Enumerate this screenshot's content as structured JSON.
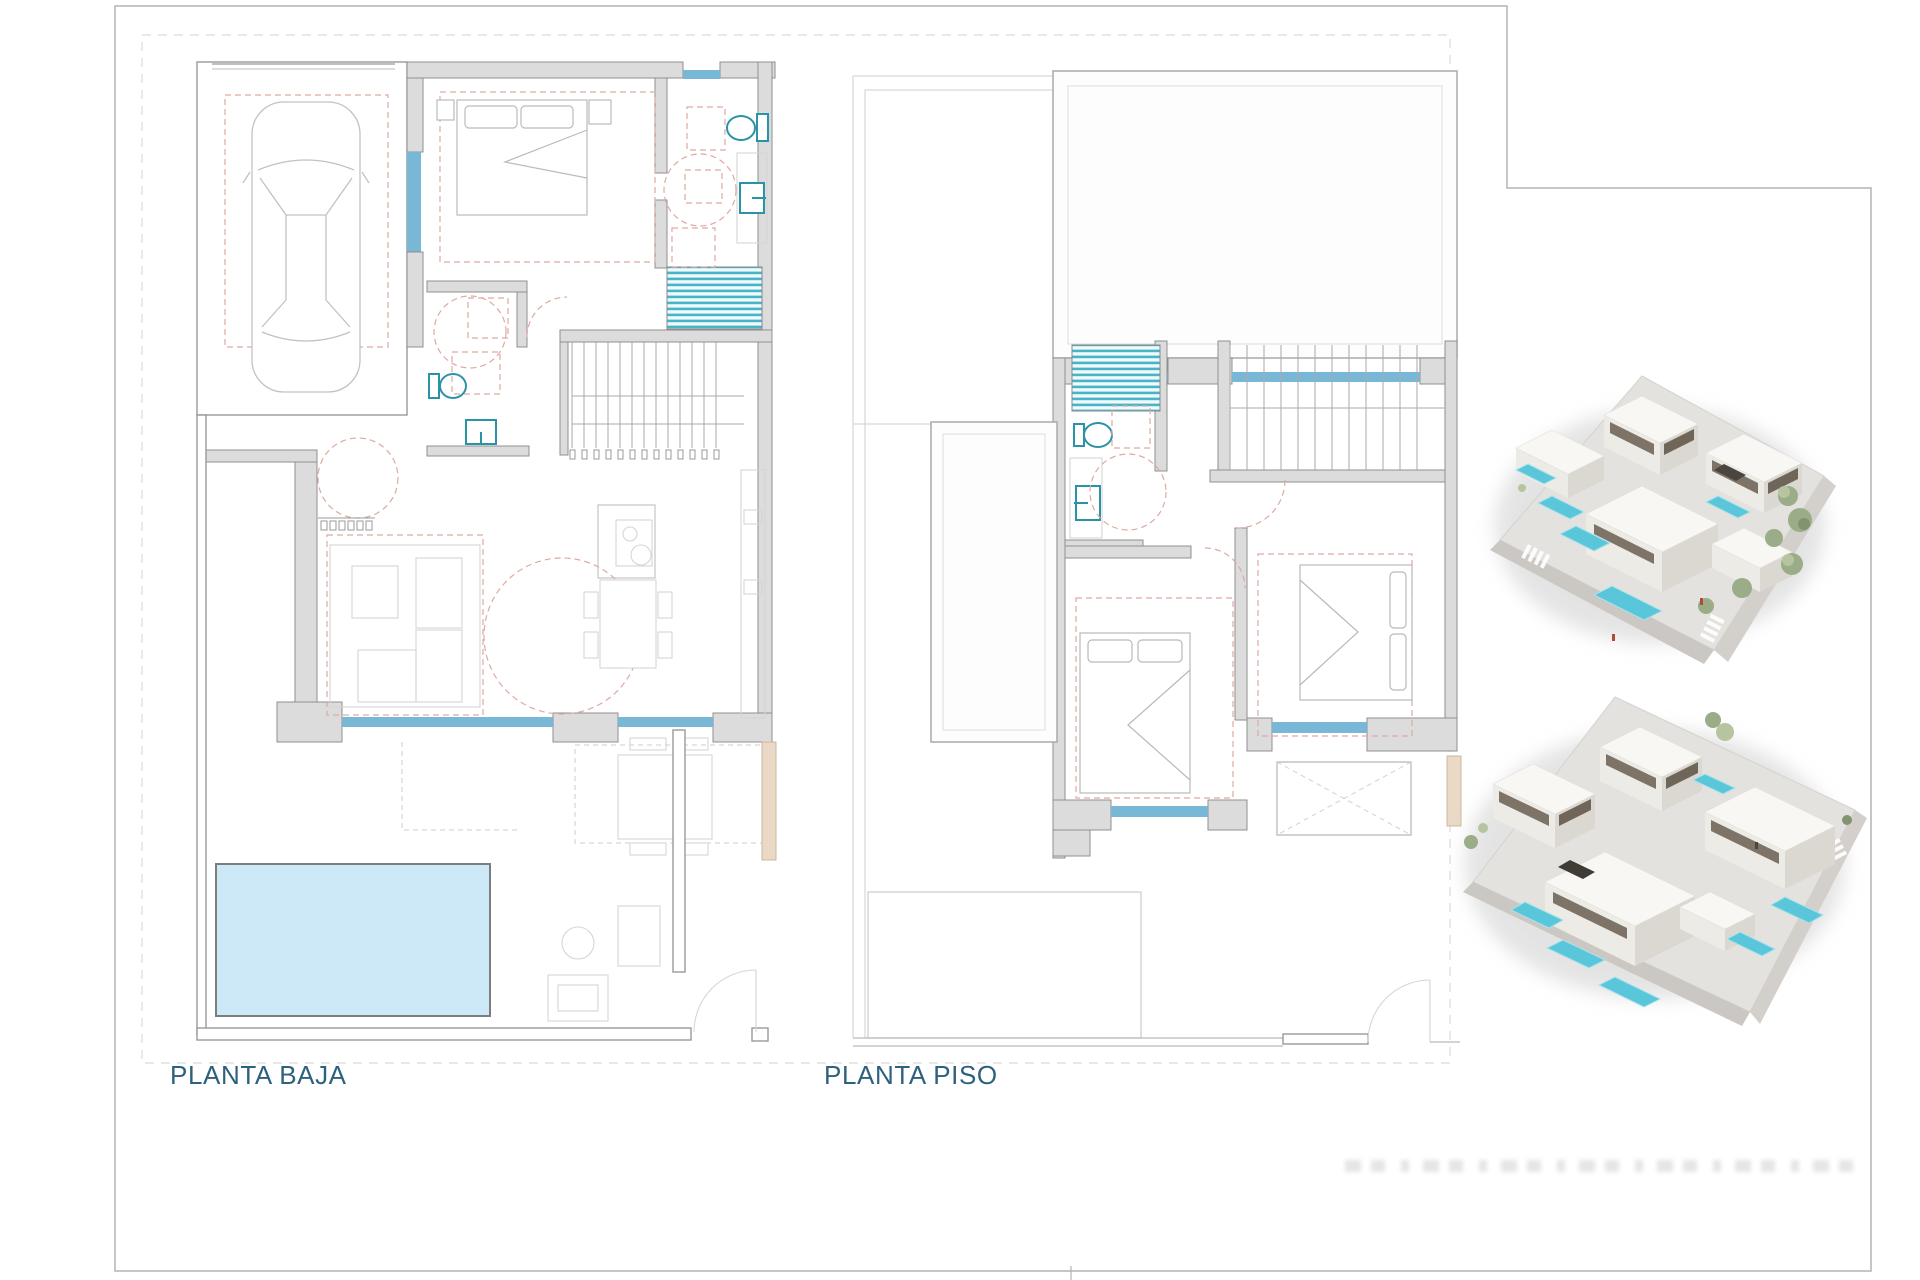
{
  "plans": {
    "ground": {
      "label": "PLANTA BAJA"
    },
    "upper": {
      "label": "PLANTA PISO"
    }
  },
  "colors": {
    "label_text": "#2e617c",
    "wall_fill": "#dcdcdc",
    "wall_stroke": "#8f8f8f",
    "window_blue": "#79b7d6",
    "pool_fill": "#cde9f7",
    "pool_border": "#7d7d7d",
    "fixture_teal": "#2b93a8",
    "shower_stripe": "#49b4c8",
    "dashed_red": "#dfa9a2",
    "plot_dash": "#dadada",
    "beige": "#e9d9c6"
  },
  "renders": {
    "top": {
      "name": "aerial-render-top"
    },
    "bottom": {
      "name": "aerial-render-bottom"
    }
  }
}
